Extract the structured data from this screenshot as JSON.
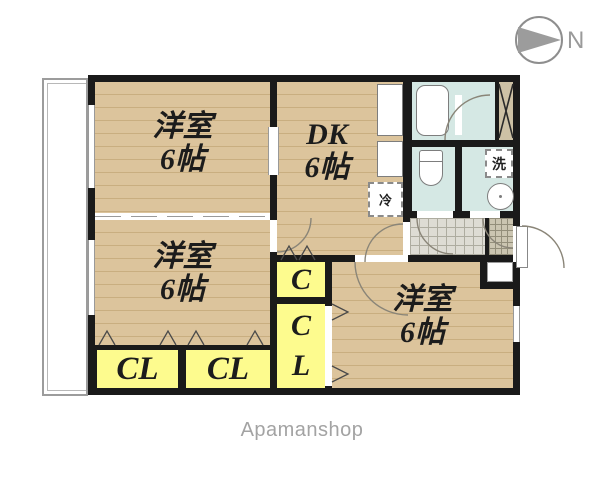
{
  "compass": {
    "label": "N"
  },
  "brand": {
    "label": "Apamanshop"
  },
  "rooms": {
    "bedroom1": {
      "name": "洋室",
      "size": "6帖"
    },
    "bedroom2": {
      "name": "洋室",
      "size": "6帖"
    },
    "bedroom3": {
      "name": "洋室",
      "size": "6帖"
    },
    "dk": {
      "name": "DK",
      "size": "6帖"
    }
  },
  "closets": {
    "cl1": "CL",
    "cl2": "CL",
    "column": {
      "top": "C",
      "bottom1": "C",
      "bottom2": "L"
    }
  },
  "fixtures": {
    "refrigerator": "冷",
    "washer": "洗"
  },
  "colors": {
    "wall": "#1a1a1a",
    "floor_tan": "#dcc49c",
    "closet_yellow": "#fdfb8e",
    "wet_blue": "#d5e8e4",
    "hall_gray": "#dedcd4",
    "genkan_gray": "#cbc5b1",
    "accent_gray": "#9a9a9a"
  }
}
